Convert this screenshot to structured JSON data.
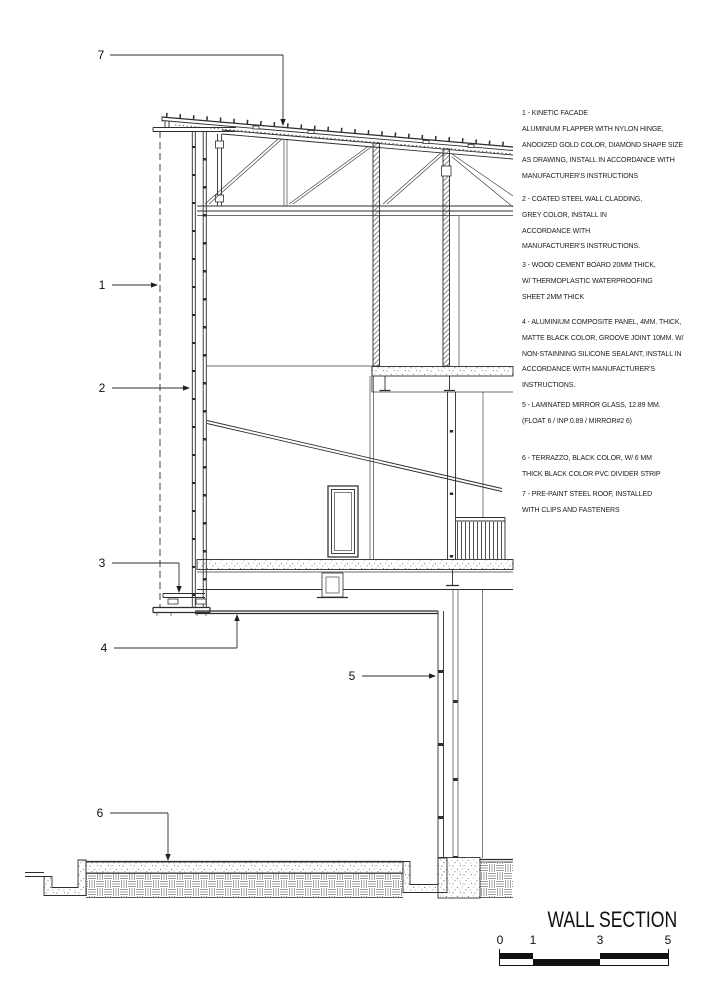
{
  "title_block": {
    "title": "WALL SECTION",
    "scale": {
      "labels": [
        "0",
        "1",
        "3",
        "5"
      ]
    }
  },
  "drawing": {
    "callouts": [
      {
        "label": "1"
      },
      {
        "label": "2"
      },
      {
        "label": "3"
      },
      {
        "label": "4"
      },
      {
        "label": "5"
      },
      {
        "label": "6"
      },
      {
        "label": "7"
      }
    ]
  },
  "notes": {
    "items": [
      {
        "number": "1",
        "text": "1 - KINETIC FACADE\nALUMINIUM FLAPPER WITH NYLON HINGE,\nANODIZED GOLD COLOR, DIAMOND SHAPE SIZE\nAS DRAWING, INSTALL IN ACCORDANCE WITH\nMANUFACTURER'S INSTRUCTIONS"
      },
      {
        "number": "2",
        "text": "2 - COATED STEEL WALL CLADDING,\nGREY COLOR, INSTALL IN\nACCORDANCE WITH\nMANUFACTURER'S INSTRUCTIONS."
      },
      {
        "number": "3",
        "text": "3 - WOOD CEMENT BOARD 20MM THICK,\nW/ THERMOPLASTIC WATERPROOFING\nSHEET 2MM THICK"
      },
      {
        "number": "4",
        "text": "4 - ALUMINIUM COMPOSITE PANEL, 4MM. THICK,\nMATTE BLACK COLOR, GROOVE JOINT 10MM. W/\nNON-STAINNING SILICONE SEALANT, INSTALL IN\nACCORDANCE WITH MANUFACTURER'S\nINSTRUCTIONS."
      },
      {
        "number": "5",
        "text": "5 - LAMINATED MIRROR GLASS, 12.89 MM.\n(FLOAT 6 / INP 0.89 / MIRROR#2 6)"
      },
      {
        "number": "6",
        "text": "6 - TERRAZZO, BLACK COLOR, W/ 6 MM\nTHICK BLACK COLOR PVC DIVIDER STRIP"
      },
      {
        "number": "7",
        "text": "7 - PRE-PAINT STEEL ROOF, INSTALLED\nWITH CLIPS AND FASTENERS"
      }
    ]
  },
  "colors": {
    "line": "#2d2d2d",
    "text": "#1b1b1b",
    "background": "#ffffff"
  }
}
